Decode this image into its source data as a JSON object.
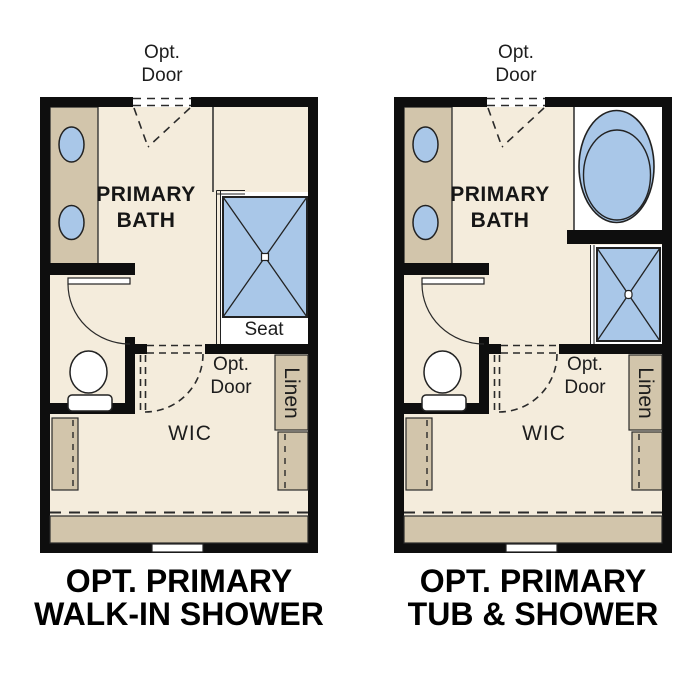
{
  "colors": {
    "wall": "#0e0e0e",
    "floor": "#f4ecdc",
    "cabinet_tan": "#d2c5ab",
    "fixture_blue": "#a9c7e8",
    "thin_line": "#2a2a2a",
    "fixture_white": "#ffffff"
  },
  "plans": [
    {
      "id": "walk-in-shower-option",
      "caption_line1": "OPT. PRIMARY",
      "caption_line2": "WALK-IN SHOWER",
      "labels": {
        "top_door_line1": "Opt.",
        "top_door_line2": "Door",
        "room_line1": "PRIMARY",
        "room_line2": "BATH",
        "seat": "Seat",
        "wic_door_line1": "Opt.",
        "wic_door_line2": "Door",
        "wic": "WIC",
        "linen": "Linen"
      }
    },
    {
      "id": "tub-and-shower-option",
      "caption_line1": "OPT. PRIMARY",
      "caption_line2": "TUB & SHOWER",
      "labels": {
        "top_door_line1": "Opt.",
        "top_door_line2": "Door",
        "room_line1": "PRIMARY",
        "room_line2": "BATH",
        "wic_door_line1": "Opt.",
        "wic_door_line2": "Door",
        "wic": "WIC",
        "linen": "Linen"
      }
    }
  ]
}
